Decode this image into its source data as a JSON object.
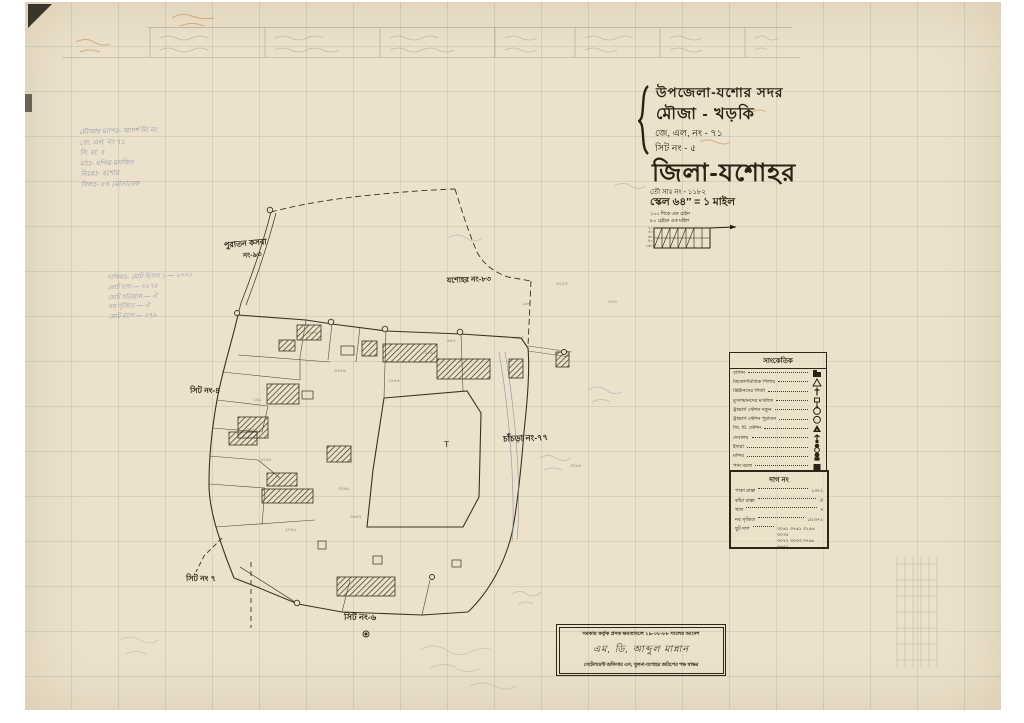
{
  "title_block": {
    "upazila": "উপজেলা-যশোর সদর",
    "mouza": "মৌজা - খড়কি",
    "jl_no": "জে, এল, নং - ৭১",
    "sheet_no": "সিট নং - ৫",
    "district": "জিলা-যশোহর",
    "touzi_no": "তৌ সাঃ নং - ১১৮২",
    "scale": "স্কেল ৬৪″ = ১ মাইল",
    "scale_note1": "১০০ শিকে এক চেইন",
    "scale_note2": "৮০ চেইনে এক মাইল",
    "scalebar_labels": [
      "২০",
      "৪০",
      "৬০",
      "৮০",
      "১৬০"
    ]
  },
  "legend": {
    "title": "সাংকেতিক",
    "items": [
      {
        "label": "বাগান",
        "symbol": "garden"
      },
      {
        "label": "ত্রিকোণমিতিক পিলার",
        "symbol": "triangle"
      },
      {
        "label": "খ্রিষ্টানদের গির্জা",
        "symbol": "cross"
      },
      {
        "label": "মুসলমানদের মসজিদ",
        "symbol": "square-pole"
      },
      {
        "label": "ট্রাভার্স স্টেশন নতুন",
        "symbol": "circle-square"
      },
      {
        "label": "ট্রাভার্স স্টেশন পুরাতন",
        "symbol": "circle"
      },
      {
        "label": "জি. টি. স্টেশন",
        "symbol": "filled-triangle"
      },
      {
        "label": "দেবালয়",
        "symbol": "trident"
      },
      {
        "label": "ইদারা",
        "symbol": "stacked-circle"
      },
      {
        "label": "মন্দির",
        "symbol": "dome"
      },
      {
        "label": "পান বরজ",
        "symbol": "filled-square"
      }
    ]
  },
  "plot_legend": {
    "title": "দাগ নং",
    "rows": [
      {
        "label": "পাকা রাস্তা",
        "value": "১৩৭২"
      },
      {
        "label": "কাঁচা রাস্তা",
        "value": "ঐ"
      },
      {
        "label": "খাল",
        "value": "×"
      },
      {
        "label": "নব সৃজিত",
        "value": "১/১৩৭২"
      },
      {
        "label": "ছুট দাগ",
        "value": "৩০৬১ ৩৭৬১ ৩১৫৬ ৩০৩৫\n৩০৭২ ৩০৩৩ ৩৭৬৮ ৩৬৪২"
      }
    ]
  },
  "stamp_box": {
    "line1": "সরকার কর্তৃক প্রদত্ত ক্ষমতাবলে ১৯-০৮-৮৮ সালের আদেশ",
    "line2": "এম, ডি, আব্দুল মান্নান",
    "line3": "সেটেলমেন্ট অফিসার এস, খুলনা-যশোহর জরিপের পক্ষ স্বাক্ষর"
  },
  "map_labels": [
    {
      "text": "পুরাতন কসবা",
      "x": 224,
      "y": 238,
      "size": 8,
      "rot": -5
    },
    {
      "text": "নং-৯৩",
      "x": 243,
      "y": 249,
      "size": 7,
      "rot": -5
    },
    {
      "text": "যশোহর নং-৮৩",
      "x": 447,
      "y": 275,
      "size": 7.5,
      "rot": -2
    },
    {
      "text": "সিট নং-৪",
      "x": 190,
      "y": 385,
      "size": 8,
      "rot": 0
    },
    {
      "text": "চাঁচড়া নং-৭৭",
      "x": 503,
      "y": 432,
      "size": 8.5,
      "rot": -2
    },
    {
      "text": "সিট নং ৭",
      "x": 186,
      "y": 573,
      "size": 8,
      "rot": 0
    },
    {
      "text": "সিট নং-৬",
      "x": 344,
      "y": 611,
      "size": 8.5,
      "rot": 0
    }
  ],
  "plot_numbers": [
    {
      "text": "৩০৩৫",
      "x": 306,
      "y": 330
    },
    {
      "text": "৩৫৪৬",
      "x": 334,
      "y": 368
    },
    {
      "text": "১৭৪৬",
      "x": 388,
      "y": 378
    },
    {
      "text": "৩১৪২",
      "x": 424,
      "y": 350
    },
    {
      "text": "৬৫৪",
      "x": 447,
      "y": 338
    },
    {
      "text": "৪৫৪৩",
      "x": 512,
      "y": 335
    },
    {
      "text": "২৪১",
      "x": 253,
      "y": 397
    },
    {
      "text": "৩৮৪১",
      "x": 246,
      "y": 427
    },
    {
      "text": "১০৪৮",
      "x": 260,
      "y": 457
    },
    {
      "text": "৩০৪৮",
      "x": 338,
      "y": 486
    },
    {
      "text": "৩৬৪২",
      "x": 350,
      "y": 514
    },
    {
      "text": "২০৪১",
      "x": 285,
      "y": 527
    },
    {
      "text": "৪২০৩",
      "x": 556,
      "y": 281
    },
    {
      "text": "৩০৪৫",
      "x": 570,
      "y": 463
    },
    {
      "text": "১৬৭",
      "x": 522,
      "y": 301
    },
    {
      "text": "৪০৩",
      "x": 608,
      "y": 299
    }
  ],
  "notes": {
    "block1": {
      "x": 80,
      "y": 127,
      "lines": [
        "মৌজার ম্যাপঃ- আদর্শ লি নং",
        "জে. এল. নং ৭১",
        "সি. মা. ৫",
        "মঠঃ- মন্দির মসজিদ",
        "নিঃরঃ- যশোর",
        "সিলঃ- ৮৪ মোতাবেক"
      ]
    },
    "block2": {
      "x": 108,
      "y": 272,
      "lines": [
        "দাখিলঃ- মোট হিসাব ১ — ২০০১",
        "মোট দাগ — ৩২৭৪",
        "মোট খতিয়ান — ঐ",
        "নব সৃজিত — ঐ",
        "মোট ম্যাপ — ৩৭৯"
      ]
    }
  }
}
